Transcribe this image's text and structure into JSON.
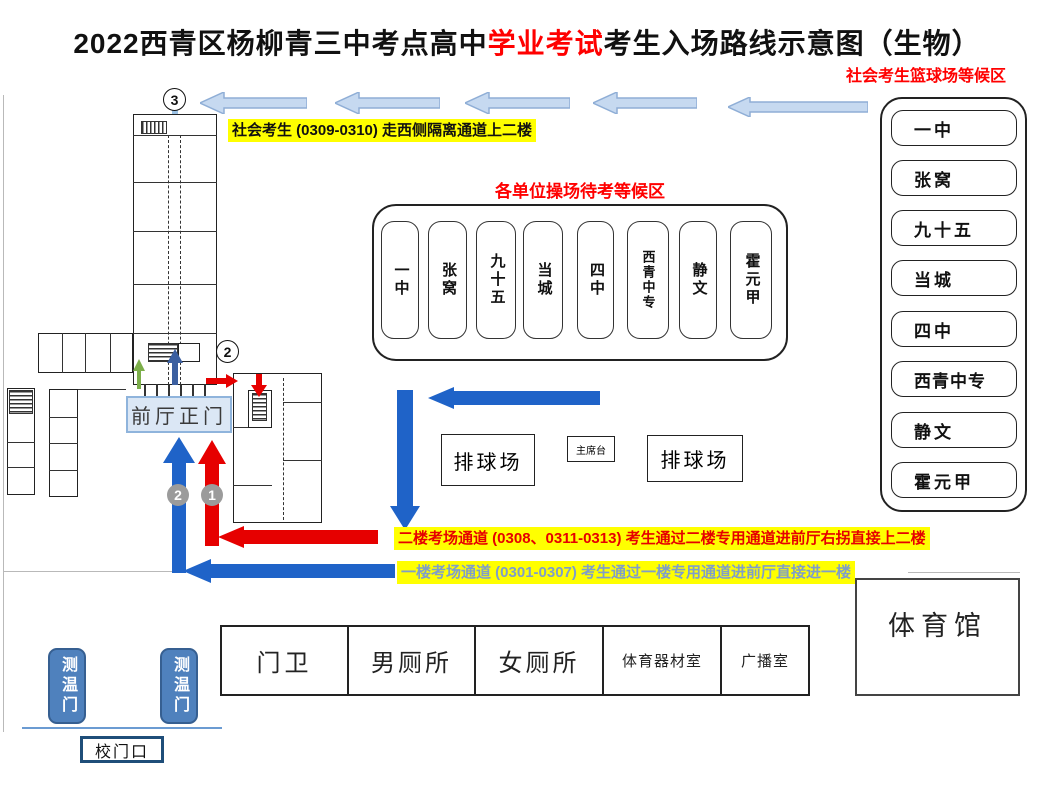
{
  "title": {
    "part1": "2022西青区杨柳青三中考点高中",
    "highlight": "学业考试",
    "part2": "考生入场路线示意图（生物）"
  },
  "notes": {
    "social": "社会考生 (0309-0310) 走西侧隔离通道上二楼",
    "floor2": "二楼考场通道 (0308、0311-0313) 考生通过二楼专用通道进前厅右拐直接上二楼",
    "floor1": "一楼考场通道 (0301-0307) 考生通过一楼专用通道进前厅直接进一楼"
  },
  "playground": {
    "title": "各单位操场待考等候区",
    "units": [
      "一中",
      "张窝",
      "九十五",
      "当城",
      "四中",
      "西青中专",
      "静文",
      "霍元甲"
    ]
  },
  "basketball": {
    "title": "社会考生篮球场等候区",
    "units": [
      "一中",
      "张窝",
      "九十五",
      "当城",
      "四中",
      "西青中专",
      "静文",
      "霍元甲"
    ]
  },
  "field": {
    "volleyball_left": "排球场",
    "stage": "主席台",
    "volleyball_right": "排球场"
  },
  "facilities": {
    "cells": [
      "门卫",
      "男厕所",
      "女厕所",
      "体育器材室",
      "广播室"
    ],
    "gym": "体育馆"
  },
  "entrance": {
    "front_hall": "前厅正门",
    "temp_gate_left": "测温门",
    "temp_gate_right": "测温门",
    "school_gate": "校门口"
  },
  "markers": {
    "route3": "3",
    "route2_top": "2",
    "route2_arrow": "2",
    "route1_arrow": "1"
  },
  "colors": {
    "highlight_bg": "#ffff00",
    "red": "#e60000",
    "blue_route": "#1f63c8",
    "light_blue_arrow": "#c6d9f0",
    "light_blue_stroke": "#8faed6",
    "green_arrow": "#7cae4a",
    "small_blue_arrow": "#3b5fa0",
    "floor1_text": "#7f9ec9",
    "gate_blue": "#4f81bd"
  }
}
